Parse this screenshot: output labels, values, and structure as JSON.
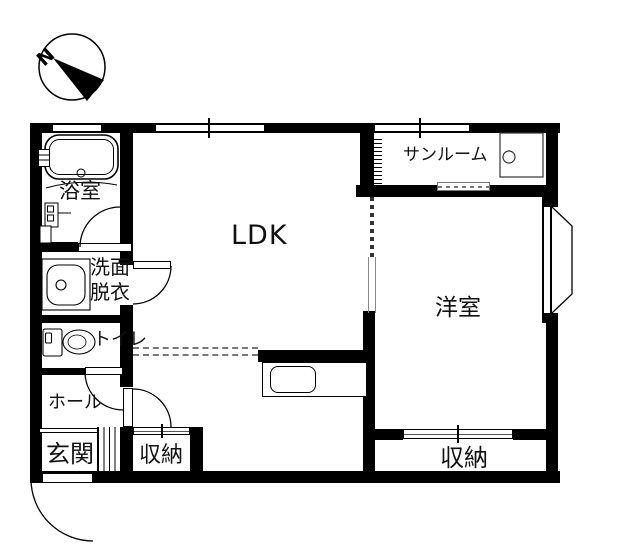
{
  "compass": {
    "north_label": "N"
  },
  "rooms": {
    "bath": {
      "label": "浴室"
    },
    "washroom": {
      "label_line1": "洗面",
      "label_line2": "脱衣"
    },
    "toilet": {
      "label": "トイレ"
    },
    "hall": {
      "label": "ホール"
    },
    "entrance": {
      "label": "玄関"
    },
    "storage_hall": {
      "label": "収納"
    },
    "ldk": {
      "label": "LDK"
    },
    "sunroom": {
      "label": "サンルーム"
    },
    "western_room": {
      "label": "洋室"
    },
    "storage_west": {
      "label": "収納"
    }
  },
  "colors": {
    "wall": "#000000",
    "background": "#ffffff",
    "thin_line": "#333333",
    "dashed_line": "#777777"
  }
}
